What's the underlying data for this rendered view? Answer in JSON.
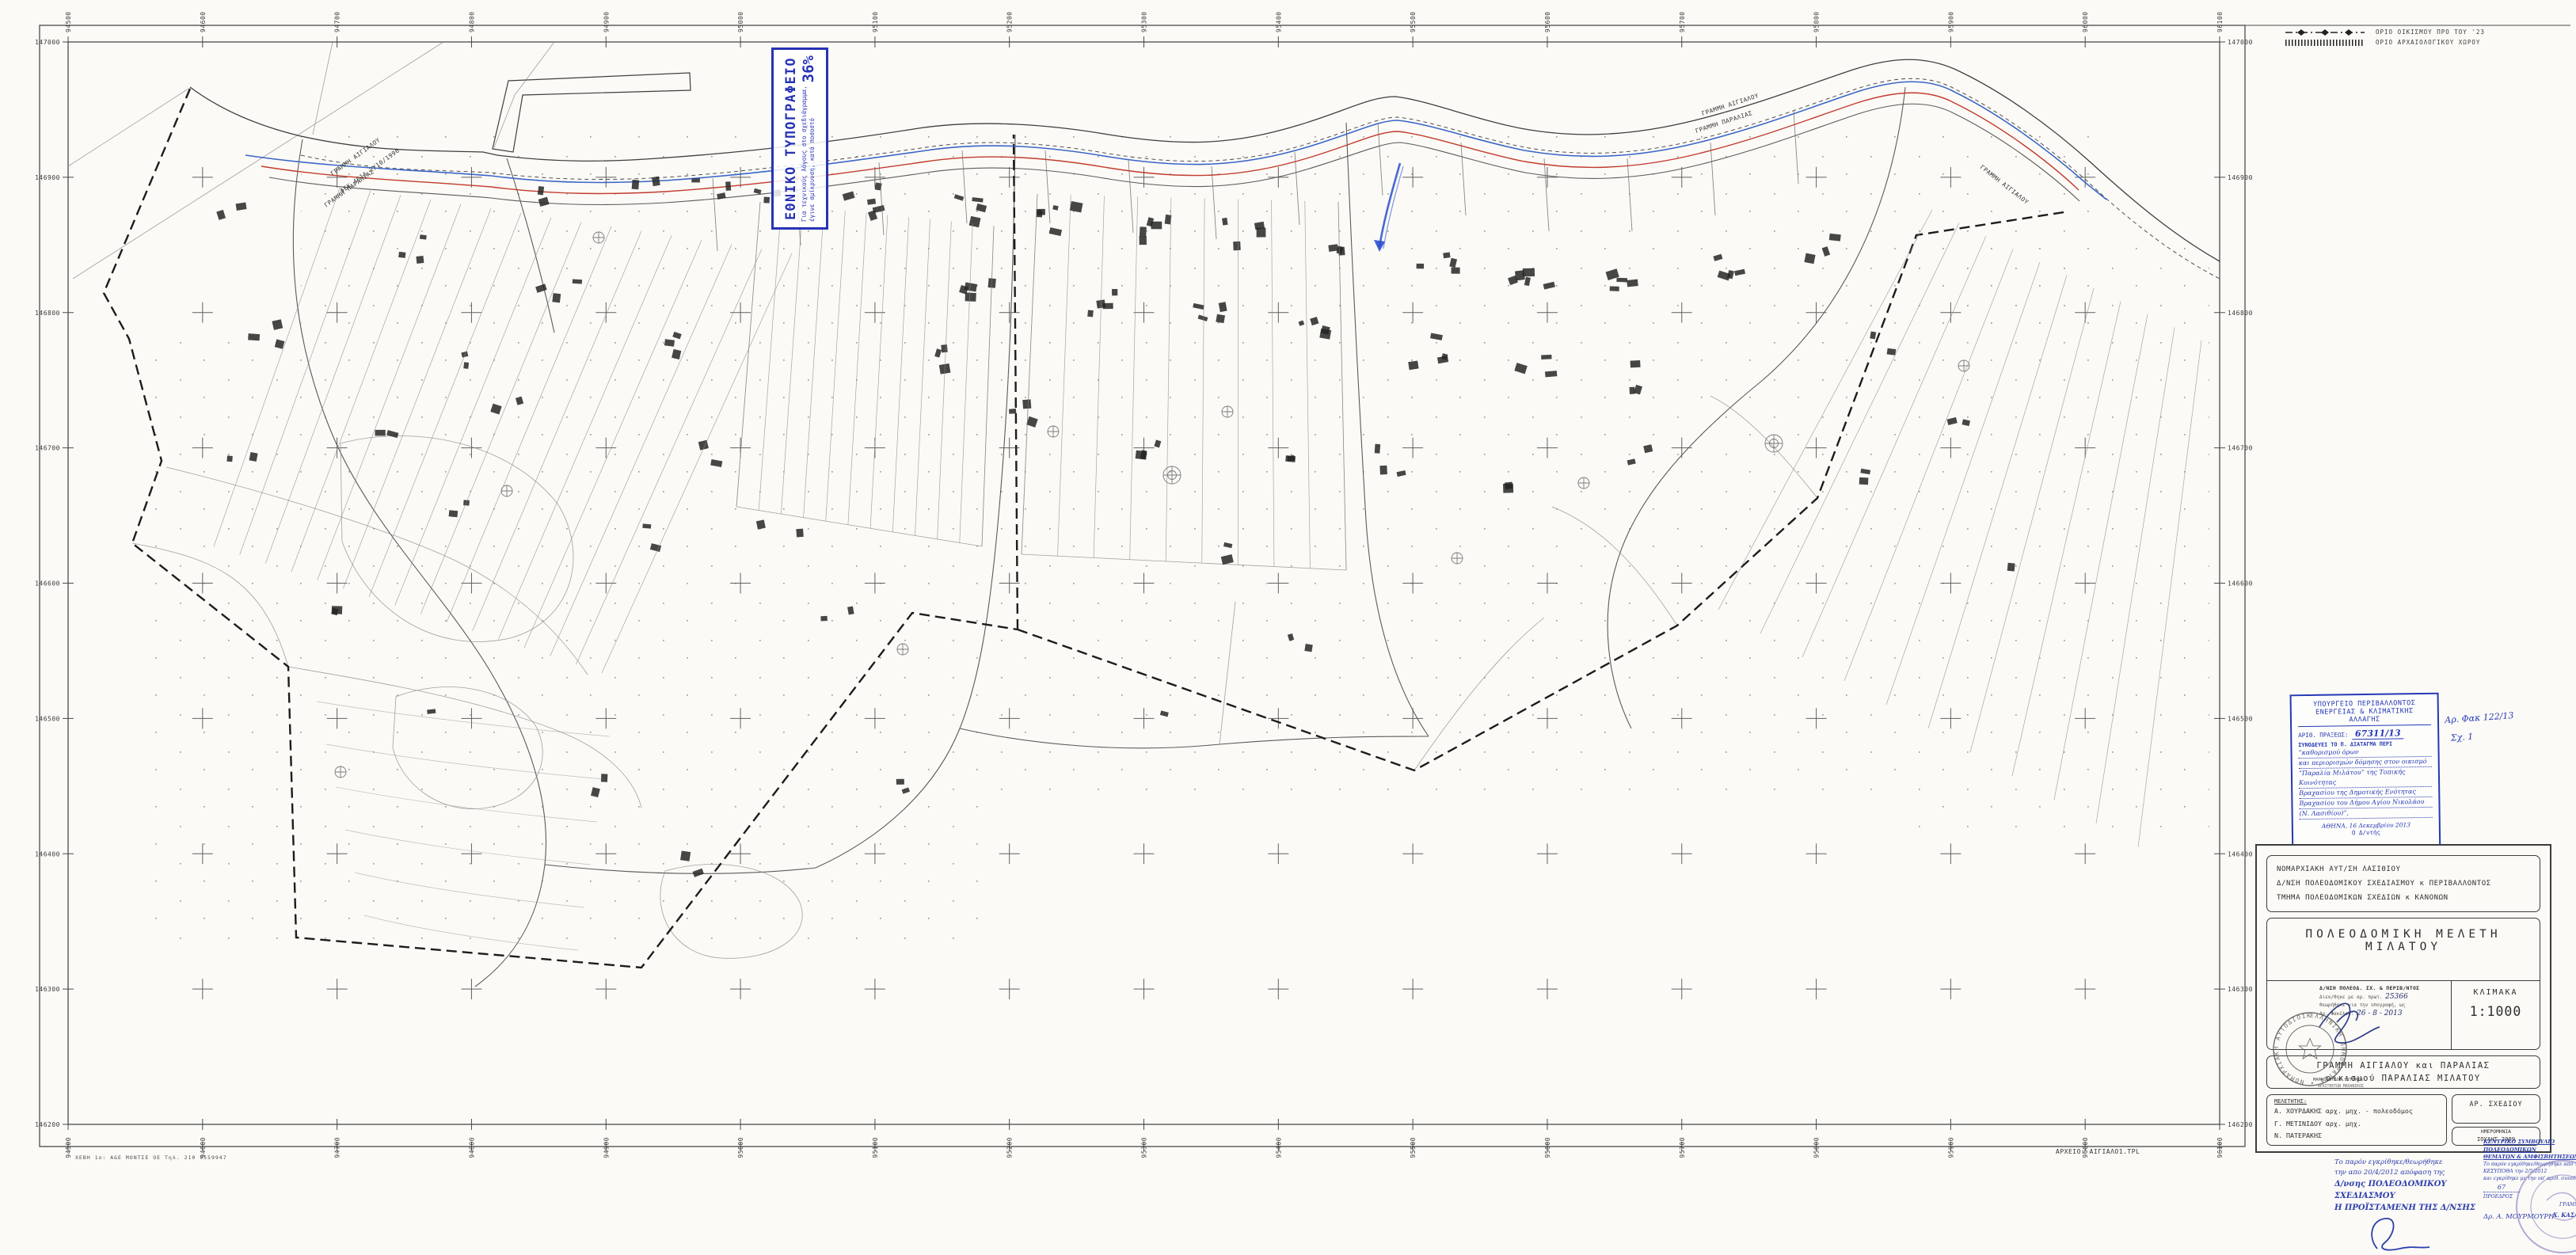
{
  "printer_stamp": {
    "title": "ΕΘΝΙΚΟ ΤΥΠΟΓΡΑΦΕΙΟ",
    "note_line1": "Για τεχνικούς λόγους στο σχεδιάγραμμα,",
    "note_line2": "έγινε σμίκρυνση, κατά ποσοστό",
    "percent": "36%"
  },
  "legend": {
    "item1": "ΟΡΙΟ ΟΙΚΙΣΜΟΥ ΠΡΟ ΤΟΥ '23",
    "item2": "ΟΡΙΟ ΑΡΧΑΙΟΛΟΓΙΚΟΥ ΧΩΡΟΥ"
  },
  "grid": {
    "top": [
      "94500",
      "94600",
      "94700",
      "94800",
      "94900",
      "95000",
      "95100",
      "95200",
      "95300",
      "95400",
      "95500",
      "95600",
      "95700",
      "95800",
      "95900",
      "96000",
      "96100"
    ],
    "left": [
      "147000",
      "146900",
      "146800",
      "146700",
      "146600",
      "146500",
      "146400",
      "146300",
      "146200"
    ]
  },
  "map_labels": {
    "aigialos": "ΓΡΑΜΜΗ ΑΙΓΙΑΛΟΥ",
    "fek": "ΦΕΚ 461Δ 2/10/1996",
    "paralia": "ΓΡΑΜΜΗ ΠΑΡΑΛΙΑΣ",
    "archive": "ΑΡΧΕΙΟ: ΑΙΓΙΑΛΟ1.ΤΡL"
  },
  "ministry_stamp": {
    "header1": "ΥΠΟΥΡΓΕΙΟ ΠΕΡΙΒΑΛΛΟΝΤΟΣ",
    "header2": "ΕΝΕΡΓΕΙΑΣ & ΚΛΙΜΑΤΙΚΗΣ ΑΛΛΑΓΗΣ",
    "praxis_label": "ΑΡΙΘ. ΠΡΑΞΕΩΣ:",
    "praxis_value": "67311/13",
    "accompanies": "ΣΥΝΟΔΕΥΕΙ ΤΟ Π. ΔΙΑΤΑΓΜΑ ΠΕΡΙ",
    "hand_lines": [
      "“καθορισμού όρων",
      "και περιορισμών δόμησης στον οικισμό",
      "“Παραλία Μιλάτου” της Τοπικής Κοινότητας",
      "Βραχασίου της Δημοτικής Ενότητας",
      "Βραχασίου του Δήμου Αγίου Νικολάου",
      "(Ν. Λασιθίου)”,"
    ],
    "athens_date": "ΑΘΗΝΑ, 16 Δεκεμβρίου 2013",
    "role": "Ο Δ/ντής",
    "signature": "Γεώργιος Φαρμάκης",
    "side_note1": "Αρ. Φακ 122/13",
    "side_note2": "Σχ. 1"
  },
  "title_block": {
    "agency_line1": "ΝΟΜΑΡΧΙΑΚΗ ΑΥΤ/ΣΗ  ΛΑΣΙΘΙΟΥ",
    "agency_line2": "Δ/ΝΣΗ ΠΟΛΕΟΔΟΜΙΚΟΥ ΣΧΕΔΙΑΣΜΟΥ κ ΠΕΡΙΒΑΛΛΟΝΤΟΣ",
    "agency_line3": "ΤΜΗΜΑ ΠΟΛΕΟΔΟΜΙΚΩΝ ΣΧΕΔΙΩΝ κ ΚΑΝΟΝΩΝ",
    "study_title": "ΠΟΛΕΟΔΟΜΙΚΗ  ΜΕΛΕΤΗ  ΜΙΛΑΤΟΥ",
    "approval": {
      "line1": "Δ/ΝΣΗ ΠΟΛΕΟΔ. ΣΧ. & ΠΕΡΙΒ/ΝΤΟΣ",
      "line2_label": "Διεκ/θηκε με αρ. πρωτ.",
      "line2_value": "25366",
      "line3": "θεωρήθηκε για την υπογραφή, ως",
      "line4_label": "Αρ. Φακέλου:",
      "line4_value": "26 - 8 - 2013",
      "seal_text": "ΕΛΛΗΝΙΚΗ ΔΗΜΟΚΡΑΤΙΑ • ΝΟΜΑΡΧΙΑΚΗ ΑΥΤΟΔΙΟΙΚΗΣΗ ΛΑΣΙΘΙΟΥ •",
      "signer_name": "ΜΑΡΚΟΠΟΥΛΟΥ ΕΥΓΕΝΙΑ",
      "signer_title": "ΑΡΧΙΤΕΚΤΩΝ ΜΗΧΑΝΙΚΟΣ"
    },
    "scale_label": "ΚΛΙΜΑΚΑ",
    "scale_value": "1:1000",
    "subject_line1": "ΓΡΑΜΜΗ ΑΙΓΙΑΛΟΥ και ΠΑΡΑΛΙΑΣ",
    "subject_line2": "οικισμού ΠΑΡΑΛΙΑΣ ΜΙΛΑΤΟΥ",
    "meletitis_label": "ΜΕΛΕΤΗΤΗΣ:",
    "meletites": [
      "Α.  ΧΟΥΡΔΑΚΗΣ  αρχ. μηχ. - πολεοδόμος",
      "Γ.  ΜΕΤΙΝΙΔΟΥ   αρχ. μηχ.",
      "Ν.  ΠΑΤΕΡΑΚΗΣ"
    ],
    "drawing_no_label": "ΑΡ. ΣΧΕΔΙΟΥ",
    "date_label": "ΗΜΕΡΟΜΗΝΙΑ",
    "date_value": "ΙΟΥΛΗΣ 2009"
  },
  "bottom_left_stamp": {
    "lines": [
      "Το παρόν εγκρίθηκε/θεωρήθηκε",
      "την απο 20/4/2012 απόφαση της",
      "Δ/νσης ΠΟΛΕΟΔΟΜΙΚΟΥ ΣΧΕΔΙΑΣΜΟΥ",
      "Η ΠΡΟΪΣΤΑΜΕΝΗ ΤΗΣ Δ/ΝΣΗΣ"
    ],
    "signature": "Α. Κονδονίκη"
  },
  "bottom_right_stamp": {
    "header1": "ΚΕΝΤΡΙΚΟ ΣΥΜΒΟΥΛΙΟ ΠΟΛΕΟΔΟΜΙΚΩΝ",
    "header2": "ΘΕΜΑΤΩΝ & ΑΜΦΙΣΒΗΤΗΣΕΩΝ",
    "line1": "Το παρόν εγκρίθηκε/θεωρήθηκε από το",
    "line2": "ΚΕΣΥΠΟΘΑ την 2/5/2012",
    "line3": "και εγκρίθηκε με την υπ' αριθ. συνεδρ.",
    "line4": "67",
    "role_left": "ΠΡΟΕΔΡΟΣ",
    "role_right": "ΓΡΑΜΜΑΤΕΑΣ",
    "sig_left": "Δρ. Α. ΜΟΥΡΜΟΥΡΗ",
    "sig_right": "Χ. ΚΑΣΑΠΗ"
  },
  "footer_print": "ΧΕΒΗ 1ο: Α&Ε ΜΟΝΤΣΕ ΟΕ   Τηλ. 210 9559947"
}
